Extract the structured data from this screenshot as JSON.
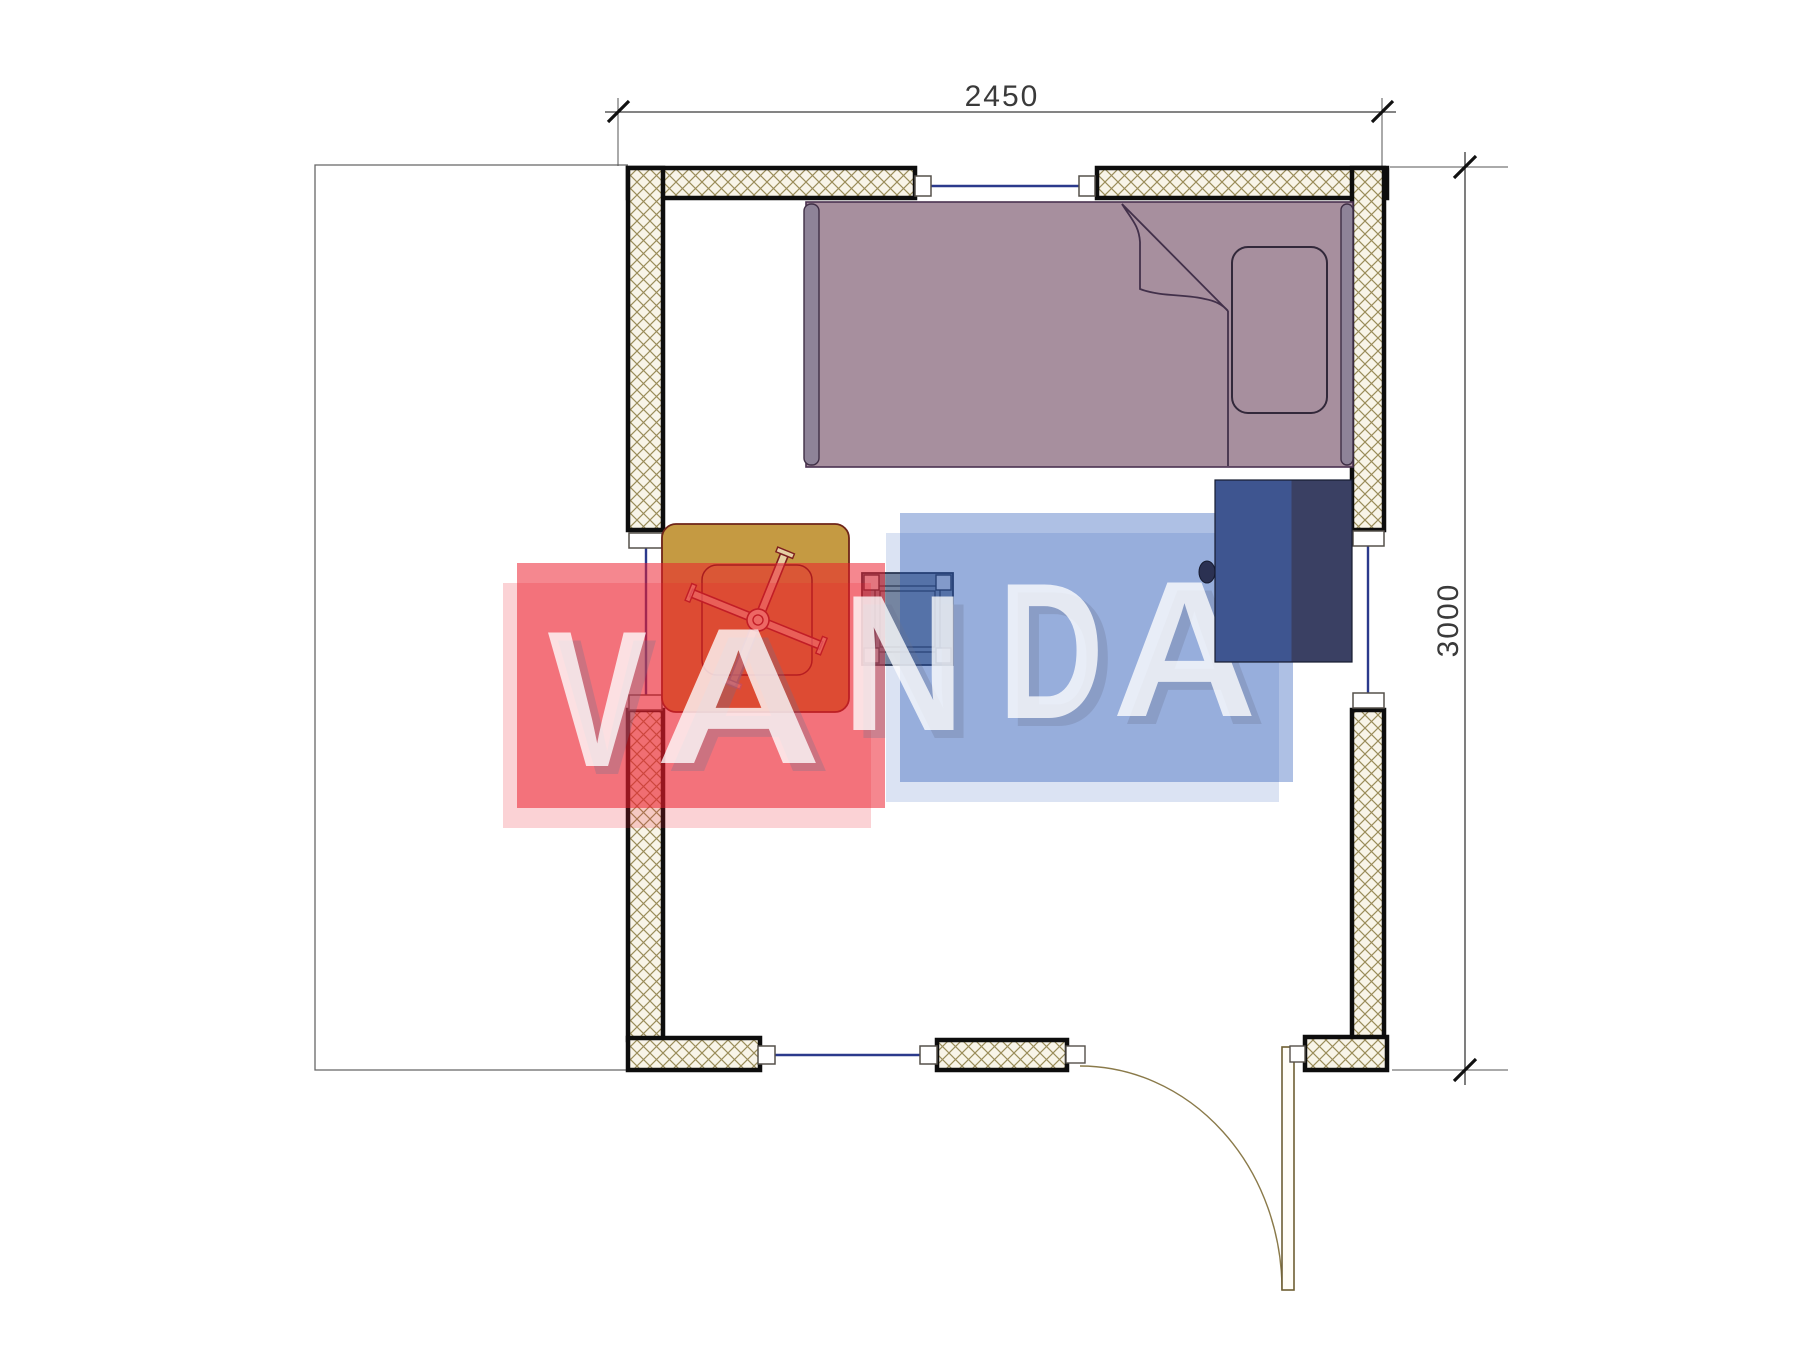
{
  "document": {
    "type": "architectural floor plan",
    "description": "room plan with hatched walls, bed, table with fan base, stool, cabinet, door and windows"
  },
  "dimensions": {
    "width_label": "2450",
    "height_label": "3000"
  },
  "watermark": {
    "text": "VANDA",
    "letters": [
      "V",
      "A",
      "N",
      "D",
      "A"
    ],
    "red_block_color": "#EC1C2B",
    "blue_block_color": "#1E50B4",
    "letter_color": "#FFFFFF"
  },
  "plan": {
    "wall_hatch_line_color": "#9A8C5A",
    "wall_hatch_bg_color": "#F8F4E8",
    "wall_border_color": "#0D0D0D",
    "window_glass_color": "#2B3A8C",
    "bed_color": "#A78F9E",
    "bed_frame_color": "#8E8398",
    "table_color": "#C59A42",
    "table_outline_color": "#6E2418",
    "stool_color": "#86909E",
    "cabinet_color": "#3A4063",
    "cabinet_tinted_color": "#3E5590",
    "door_color": "#6E5F33",
    "furniture": [
      "bed",
      "pillow",
      "blanket-fold",
      "table",
      "fan-base",
      "stool",
      "cabinet"
    ],
    "openings": [
      "window-top",
      "window-left",
      "window-right",
      "window-bottom",
      "door"
    ]
  }
}
